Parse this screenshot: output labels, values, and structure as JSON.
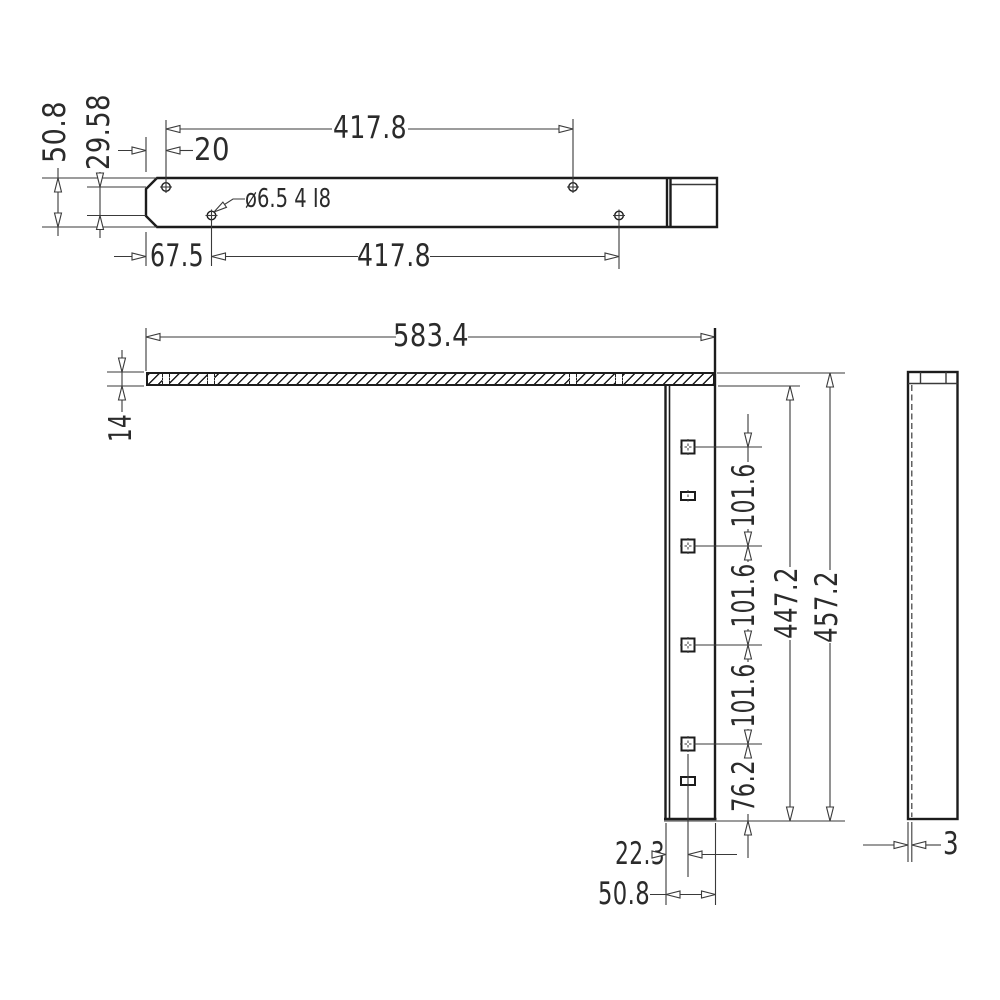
{
  "drawing": {
    "background_color": "#ffffff",
    "object_line_color": "#1c1c1c",
    "dimension_line_color": "#3a3a3a",
    "top_view": {
      "plate_height": "50.8",
      "hole_row_offset": "29.58",
      "first_hole_offset": "20",
      "top_hole_pitch": "417.8",
      "hole_callout": "ø6.5 4 I8",
      "bottom_first_hole_offset": "67.5",
      "bottom_hole_pitch": "417.8"
    },
    "front_view": {
      "plate_length": "583.4",
      "plate_thickness": "14",
      "hole_pitch_1": "101.6",
      "hole_pitch_2": "101.6",
      "hole_pitch_3": "101.6",
      "bottom_hole_offset": "76.2",
      "inner_height": "447.2",
      "overall_height": "457.2",
      "hole_offset_from_edge": "22.3",
      "leg_width": "50.8"
    },
    "side_view": {
      "wall_thickness": "3"
    }
  }
}
